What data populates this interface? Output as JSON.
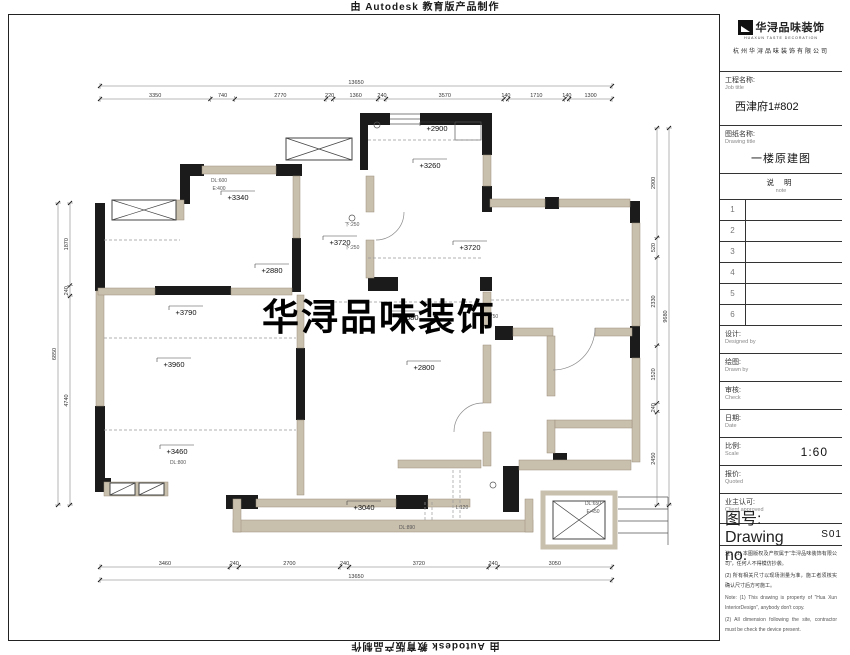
{
  "sheet": {
    "watermark_top": "由 Autodesk 教育版产品制作",
    "watermark_bottom": "由 Autodesk 教育版产品制作",
    "watermark_center": "华浔品味装饰"
  },
  "colors": {
    "wall_black": "#1b1b1b",
    "wall_tan": "#c9bfad",
    "dim_line": "#777"
  },
  "title_block": {
    "logo": {
      "text": "华浔品味装饰",
      "sub": "HUAXUN TASTE DECORATION",
      "company": "杭州华浔品味装饰有限公司"
    },
    "job": {
      "label": "工程名称:",
      "en": "Job title",
      "value": "西津府1#802"
    },
    "sheet_name": {
      "label": "图纸名称:",
      "en": "Drawing title",
      "value": "一楼原建图"
    },
    "note_header": {
      "label": "说 明",
      "en": "note"
    },
    "rows": [
      "1",
      "2",
      "3",
      "4",
      "5",
      "6"
    ],
    "designed": {
      "label": "设计:",
      "en": "Designed by"
    },
    "drawn": {
      "label": "绘图:",
      "en": "Drawn by"
    },
    "check": {
      "label": "审核:",
      "en": "Check"
    },
    "date": {
      "label": "日期:",
      "en": "Date"
    },
    "scale": {
      "label": "比例:",
      "en": "Scale",
      "value": "1:60"
    },
    "quoted": {
      "label": "报价:",
      "en": "Quoted"
    },
    "approved": {
      "label": "业主认可:",
      "en": "Client approved"
    },
    "drawing_no": {
      "label": "图号:",
      "en": "Drawing no.",
      "value": "S01"
    },
    "notes": {
      "cn1": "注：(1) 本图版权及产权属于“华浔品味装饰有限公司”，任何人不得模仿抄袭。",
      "cn2": "(2) 所有相关尺寸以现场测量为准，施工者须核实确认尺寸后方可施工。",
      "en1": "Note: (1) This drawing is property of “Hua Xun InteriorDesign”, anybody don't copy.",
      "en2": "(2) All dimension following the site, contractor must be check the device present."
    }
  },
  "plan": {
    "room_labels": [
      {
        "text": "+2900",
        "x": 437,
        "y": 131
      },
      {
        "text": "+3260",
        "x": 430,
        "y": 168
      },
      {
        "text": "+3340",
        "x": 238,
        "y": 200
      },
      {
        "text": "+3720",
        "x": 340,
        "y": 245
      },
      {
        "text": "+2880",
        "x": 272,
        "y": 273
      },
      {
        "text": "+3720",
        "x": 470,
        "y": 250
      },
      {
        "text": "+3790",
        "x": 186,
        "y": 315
      },
      {
        "text": "+3960",
        "x": 174,
        "y": 367
      },
      {
        "text": "+2680",
        "x": 408,
        "y": 320
      },
      {
        "text": "+2800",
        "x": 424,
        "y": 370
      },
      {
        "text": "+3460",
        "x": 177,
        "y": 454
      },
      {
        "text": "+3040",
        "x": 364,
        "y": 510
      }
    ],
    "annotations": [
      {
        "text": "DL:600",
        "x": 219,
        "y": 182
      },
      {
        "text": "E:400",
        "x": 219,
        "y": 190
      },
      {
        "text": "下:250",
        "x": 352,
        "y": 226
      },
      {
        "text": "下:250",
        "x": 352,
        "y": 249
      },
      {
        "text": "750",
        "x": 494,
        "y": 318
      },
      {
        "text": "DL:800",
        "x": 178,
        "y": 464
      },
      {
        "text": "L:120",
        "x": 462,
        "y": 509
      },
      {
        "text": "DL:890",
        "x": 407,
        "y": 529
      },
      {
        "text": "DL:650",
        "x": 593,
        "y": 505
      },
      {
        "text": "E:450",
        "x": 593,
        "y": 513
      }
    ],
    "dims": {
      "top_overall": [
        "13650"
      ],
      "top": [
        "3350",
        "740",
        "2770",
        "220",
        "1360",
        "240",
        "3570",
        "140",
        "1710",
        "140",
        "1300"
      ],
      "bottom": [
        "3460",
        "240",
        "2700",
        "240",
        "3720",
        "240",
        "3050"
      ],
      "bottom_overall": [
        "13650"
      ],
      "left": [
        "1870",
        "240",
        "4740"
      ],
      "left_overall": [
        "6850"
      ],
      "right": [
        "2900",
        "520",
        "2330",
        "1520",
        "240",
        "2450"
      ],
      "right_overall": [
        "9680"
      ]
    }
  }
}
